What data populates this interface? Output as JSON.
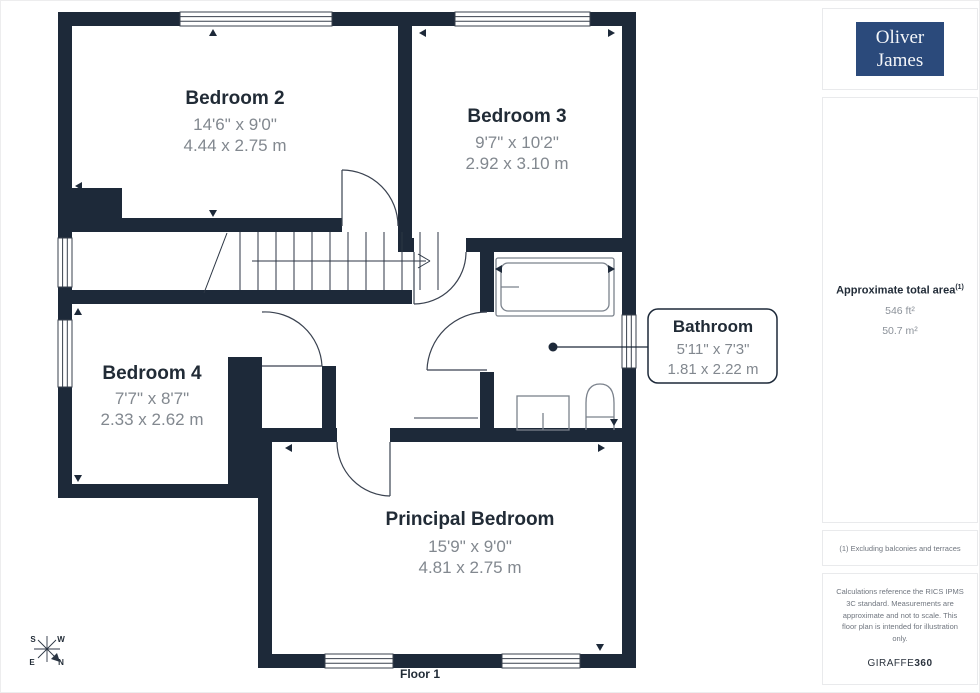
{
  "header": {
    "logo_line1": "Oliver",
    "logo_line2": "James"
  },
  "sidebar": {
    "area_title": "Approximate total area",
    "area_superscript": "(1)",
    "area_imperial": "546 ft²",
    "area_metric": "50.7 m²",
    "footnote": "(1) Excluding balconies and terraces",
    "disclaimer": "Calculations reference the RICS IPMS 3C standard. Measurements are approximate and not to scale. This floor plan is intended for illustration only.",
    "brand_name": "GIRAFFE",
    "brand_suffix": "360"
  },
  "plan": {
    "floor_label": "Floor 1",
    "compass": {
      "n": "N",
      "s": "S",
      "e": "E",
      "w": "W"
    },
    "rooms": [
      {
        "name": "Bedroom 2",
        "imperial": "14'6\" x 9'0\"",
        "metric": "4.44 x 2.75 m"
      },
      {
        "name": "Bedroom 3",
        "imperial": "9'7\" x 10'2\"",
        "metric": "2.92 x 3.10 m"
      },
      {
        "name": "Bedroom 4",
        "imperial": "7'7\" x 8'7\"",
        "metric": "2.33 x 2.62 m"
      },
      {
        "name": "Bathroom",
        "imperial": "5'11\" x 7'3\"",
        "metric": "1.81 x 2.22 m"
      },
      {
        "name": "Principal Bedroom",
        "imperial": "15'9\" x 9'0\"",
        "metric": "4.81 x 2.75 m"
      }
    ]
  },
  "colors": {
    "wall": "#1d2939",
    "logo_bg": "#2b4a7b",
    "dim_text": "#82888f",
    "border": "#e9eaec"
  }
}
